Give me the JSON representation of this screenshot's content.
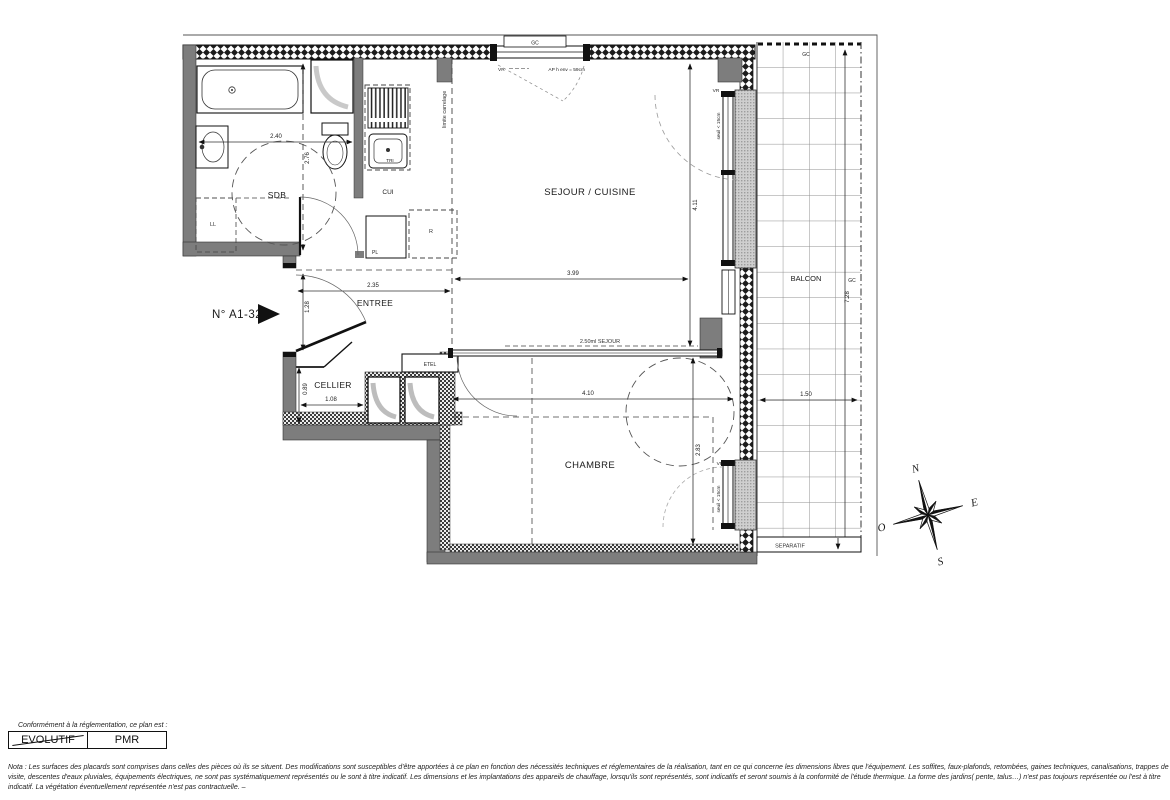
{
  "plan": {
    "unit_label": "N° A1-32",
    "rooms": {
      "sdb": "SDB",
      "cui": "CUI",
      "sejour_cuisine": "SEJOUR / CUISINE",
      "entree": "ENTREE",
      "cellier": "CELLIER",
      "chambre": "CHAMBRE",
      "balcon": "BALCON"
    },
    "fixtures": {
      "ll": "LL",
      "pl": "PL",
      "r": "R",
      "tri": "TRI",
      "etel": "ETEL"
    },
    "dimensions": {
      "sdb_width": "2.40",
      "sdb_depth": "2.76",
      "entree_width": "2.35",
      "entree_depth": "1.28",
      "cellier_width": "1.08",
      "cellier_depth": "0.89",
      "sejour_width": "3.99",
      "sejour_depth": "4.11",
      "sejour_lineal": "2.50ml SEJOUR",
      "chambre_width": "4.10",
      "chambre_depth": "2.83",
      "balcon_depth": "7.28",
      "balcon_width": "1.50"
    },
    "annotations": {
      "limite_carrelage": "limite carrelage",
      "vr": "VR",
      "seuil": "seuil < 15cm",
      "allege": "AP h env = 59cm",
      "gc": "GC",
      "separatif": "SEPARATIF"
    },
    "compass": {
      "north": "N",
      "east": "E",
      "south": "S",
      "west": "O"
    }
  },
  "legend": {
    "intro": "Conformément à la réglementation, ce plan est :",
    "evolutif": "EVOLUTIF",
    "pmr": "PMR"
  },
  "nota": {
    "line1": "Nota : Les surfaces des placards sont comprises dans celles des pièces où ils se situent. Des modifications sont susceptibles d'être apportées à ce plan en fonction des nécessités techniques et réglementaires de la réalisation, tant en ce qui concerne les dimensions libres que l'équipement.  Les soffites, faux-plafonds, retombées, gaines techniques, canalisations, trappes de",
    "line2": "visite, descentes d'eaux pluviales, équipements électriques, ne sont pas systématiquement représentés ou le sont à titre indicatif. Les dimensions et les implantations des appareils de chauffage, lorsqu'ils sont représentés, sont indicatifs et seront soumis à la conformité de l'étude thermique. La forme des jardins( pente, talus…) n'est pas toujours représentée ou l'est à titre",
    "line3": "indicatif. La végétation éventuellement représentée n'est pas contractuelle. –"
  }
}
